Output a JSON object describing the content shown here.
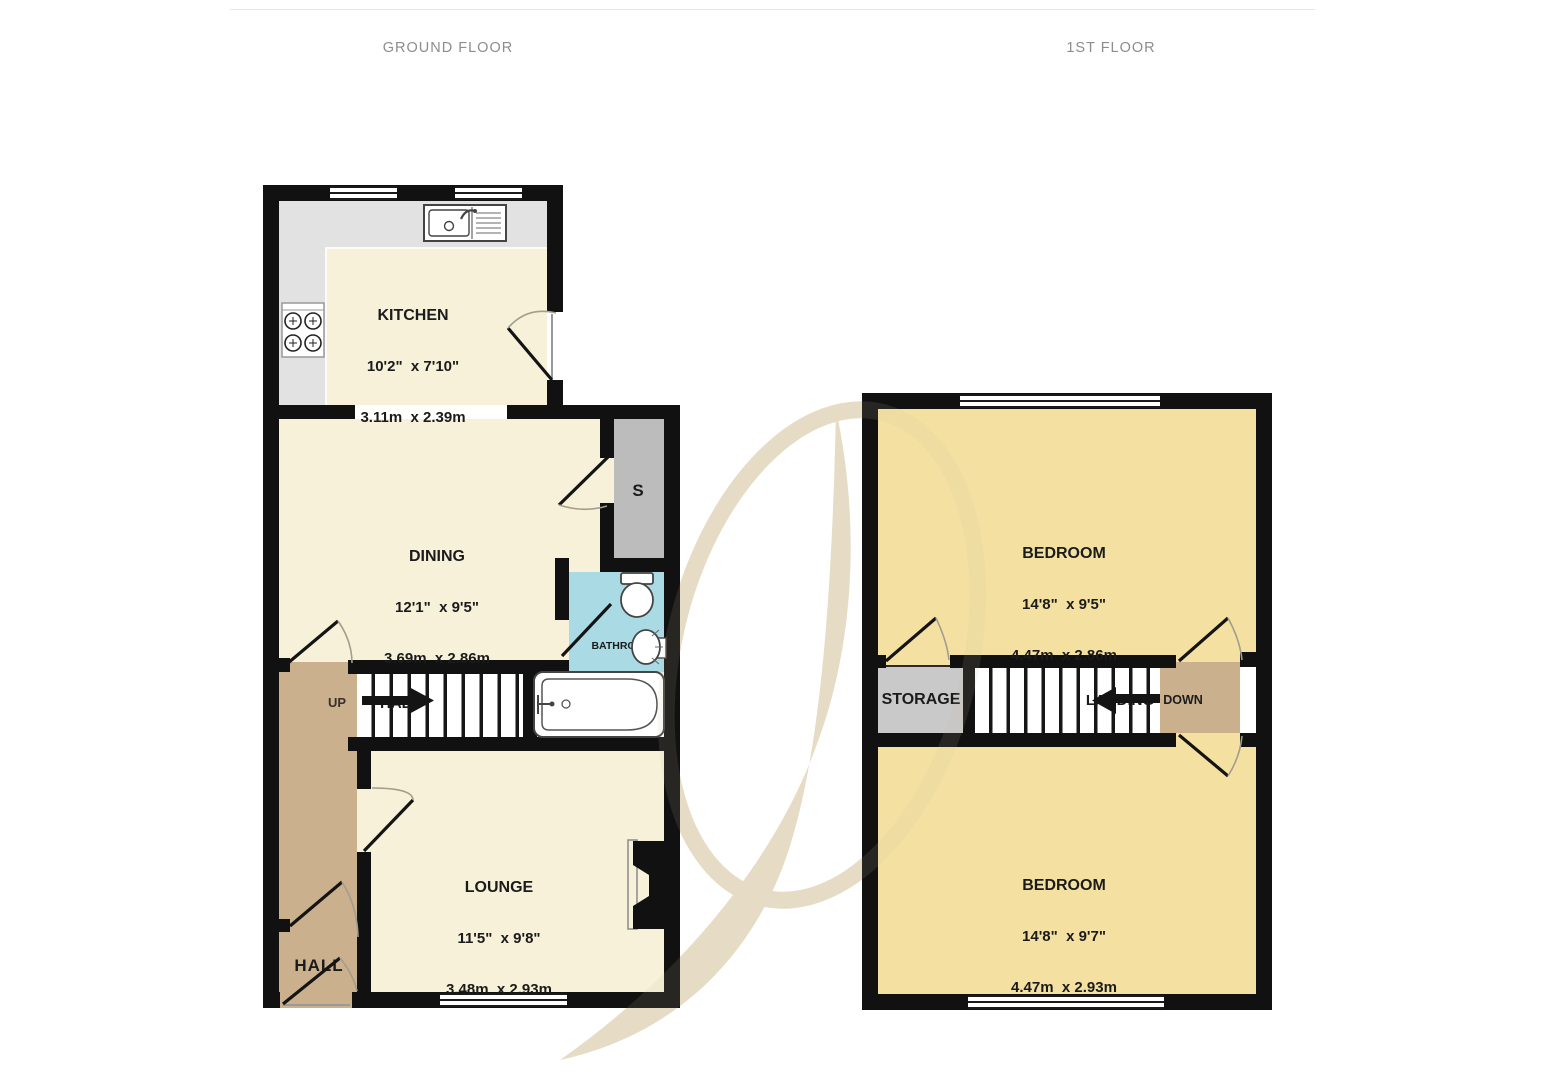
{
  "page": {
    "ground_title": "GROUND FLOOR",
    "first_title": "1ST FLOOR"
  },
  "ground_floor": {
    "kitchen": {
      "name": "KITCHEN",
      "imperial": "10'2\"  x 7'10\"",
      "metric": "3.11m  x 2.39m"
    },
    "dining": {
      "name": "DINING",
      "imperial": "12'1\"  x 9'5\"",
      "metric": "3.69m  x 2.86m"
    },
    "lounge": {
      "name": "LOUNGE",
      "imperial": "11'5\"  x 9'8\"",
      "metric": "3.48m  x 2.93m"
    },
    "hall": {
      "name": "HALL"
    },
    "stairs_label": "HALL",
    "stairs_direction": "UP",
    "bathroom": {
      "name": "BATHROOM"
    },
    "store": {
      "name": "S"
    }
  },
  "first_floor": {
    "bedroom_front": {
      "name": "BEDROOM",
      "imperial": "14'8\"  x 9'5\"",
      "metric": "4.47m  x 2.86m"
    },
    "bedroom_back": {
      "name": "BEDROOM",
      "imperial": "14'8\"  x 9'7\"",
      "metric": "4.47m  x 2.93m"
    },
    "storage": {
      "name": "STORAGE"
    },
    "landing": {
      "name": "LANDING"
    },
    "stairs_direction": "DOWN"
  },
  "colors": {
    "wall": "#111111",
    "ground_room_cream": "#f6f1d8",
    "bedroom_yellow": "#f4e1a2",
    "hall_landing_tan": "#cbb08d",
    "bathroom_blue": "#aadbe4",
    "kitchen_counter_gray": "#e2e2e2",
    "store_gray": "#bcbcbc",
    "storage_gray": "#c9c9c9",
    "watermark_beige": "#e8ddc6",
    "title_gray": "#8d8d8d"
  }
}
